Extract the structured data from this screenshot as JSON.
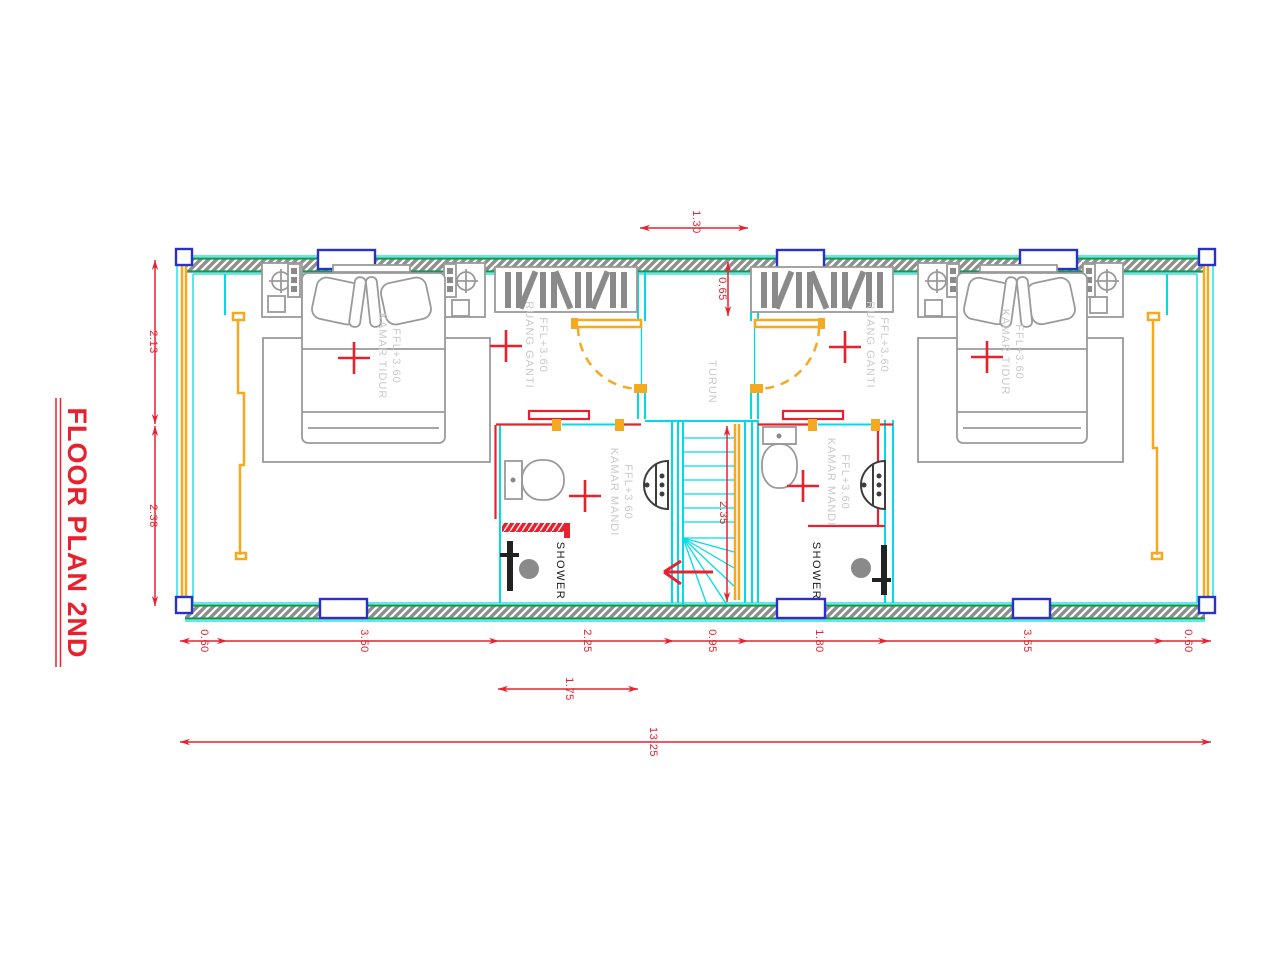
{
  "title": "FLOOR PLAN 2ND",
  "rooms": {
    "bedroom_left": {
      "name": "KAMAR TIDUR",
      "level": "FFL+3.60"
    },
    "bedroom_right": {
      "name": "KAMAR TIDUR",
      "level": "FFL+3.60"
    },
    "dressing_left": {
      "name": "RUANG GANTI",
      "level": "FFL+3.60"
    },
    "dressing_right": {
      "name": "RUANG GANTI",
      "level": "FFL+3.60"
    },
    "bathroom_left": {
      "name": "KAMAR MANDI",
      "level": "FFL+3.60"
    },
    "bathroom_right": {
      "name": "KAMAR MANDI",
      "level": "FFL+3.60"
    },
    "stairwell": {
      "name": "TURUN"
    },
    "shower_left": {
      "name": "SHOWER"
    },
    "shower_right": {
      "name": "SHOWER"
    }
  },
  "dimensions": {
    "stair_opening_width": "1.30",
    "landing_depth": "0.65",
    "left_upper": "2.13",
    "left_lower": "2.38",
    "stair_run": "2.35",
    "bottom_segments": [
      "0.60",
      "3.50",
      "2.25",
      "0.95",
      "1.80",
      "3.55",
      "0.60"
    ],
    "door_span": "1.75",
    "overall_width": "13.25"
  },
  "colors": {
    "dimension_red": "#e8212e",
    "wall_cyan": "#00dce6",
    "wall_edge_green": "#0c9c4f",
    "door_orange": "#f5a91f",
    "window_blue": "#2b31c8",
    "furniture_gray": "#9a9a9a",
    "label_gray": "#c9c9c9",
    "hatch_gray": "#8f8f8f"
  }
}
